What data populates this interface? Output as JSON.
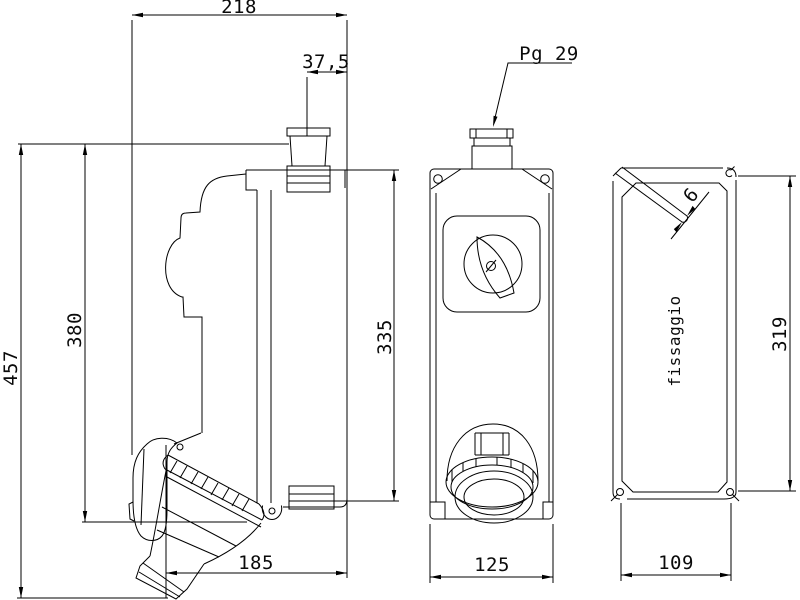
{
  "canvas": {
    "background": "#ffffff",
    "line_color": "#000000"
  },
  "side_view": {
    "dim_overall_width": "218",
    "dim_gland_offset": "37,5",
    "dim_overall_height": "457",
    "dim_body_height": "380",
    "dim_rear_height": "335",
    "dim_body_depth": "185"
  },
  "front_view": {
    "gland_callout": "Pg 29",
    "dim_body_width": "125"
  },
  "rear_view": {
    "label_mounting": "fissaggio",
    "dim_slot_width": "6",
    "dim_slot_spacing_vertical": "319",
    "dim_slot_spacing_horizontal": "109"
  }
}
